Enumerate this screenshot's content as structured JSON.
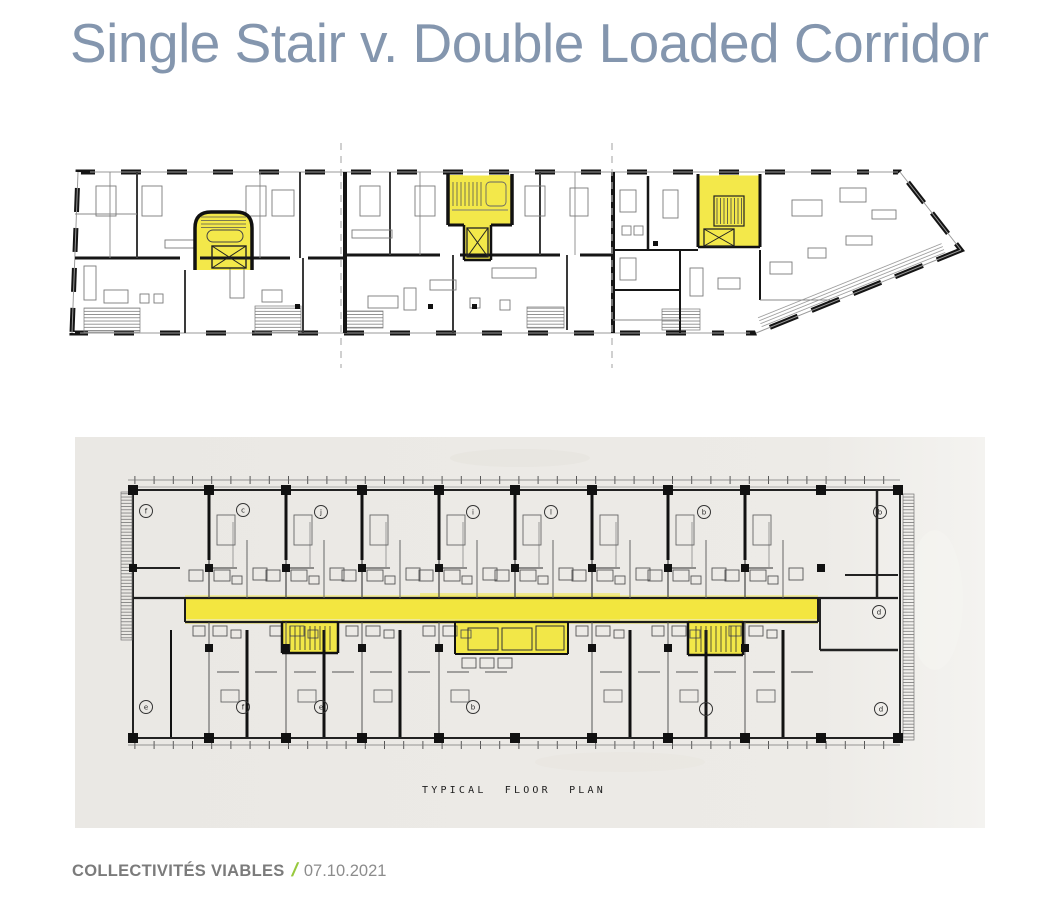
{
  "slide": {
    "title": "Single Stair v. Double Loaded Corridor",
    "footer": {
      "brand": "COLLECTIVITÉS VIABLES",
      "separator": "/",
      "date": "07.10.2021"
    }
  },
  "colors": {
    "title_blue_gray": "#8496ae",
    "footer_gray": "#7b7b7b",
    "date_gray": "#8c8c8c",
    "accent_green": "#97c93d",
    "highlight_yellow": "#f2e63b",
    "highlight_yellow_light": "#f6ec55",
    "scan_paper": "#eceae6",
    "ink": "#1f1f1f"
  },
  "top_plan": {
    "kind": "single stair building floor plan",
    "highlighted_elements": [
      "stair-core-left",
      "stair-core-center",
      "stair-core-right"
    ]
  },
  "bottom_plan": {
    "kind": "double loaded corridor floor plan",
    "caption": "TYPICAL FLOOR PLAN",
    "highlighted_elements": [
      "central-corridor",
      "stair-left",
      "elevator-lobby",
      "stair-right"
    ],
    "unit_labels": {
      "top": [
        "f",
        "c",
        "j",
        "i",
        "l",
        "b",
        "b"
      ],
      "bottom": [
        "e",
        "f",
        "e",
        "b",
        "i",
        "d"
      ],
      "right": "d"
    }
  }
}
